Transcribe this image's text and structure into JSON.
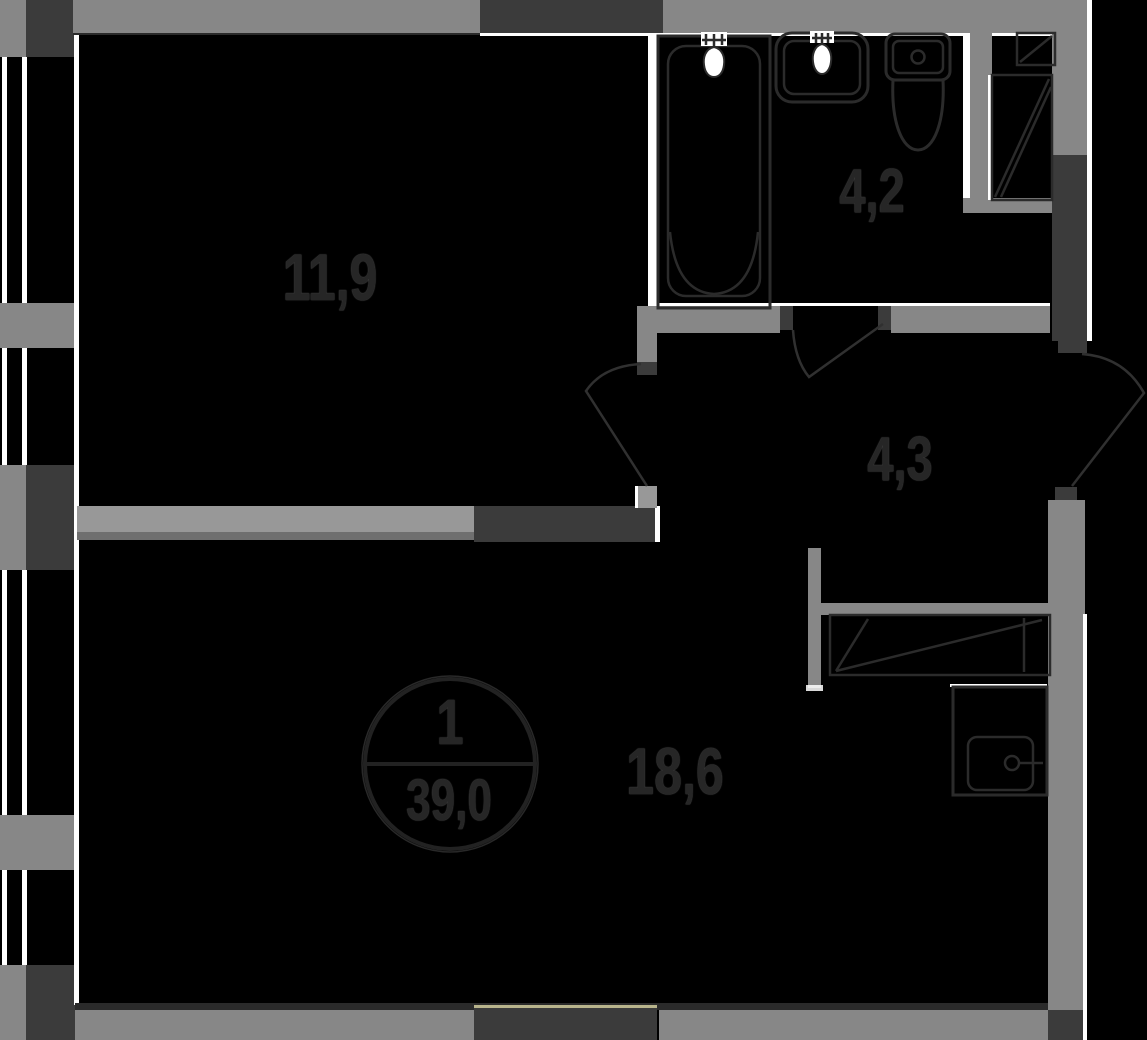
{
  "title": "apartment-floor-plan",
  "labels": {
    "room1_area": "11,9",
    "bathroom_area": "4,2",
    "hallway_area": "4,3",
    "living_area": "18,6"
  },
  "unit_stamp": {
    "number": "1",
    "total_area": "39,0"
  },
  "icons": {
    "bathtub": "bathtub-icon",
    "sink": "sink-icon",
    "toilet": "toilet-icon",
    "vent_duct_small": "vent-duct-icon",
    "vent_duct_tall": "vent-duct-icon",
    "wardrobe": "wardrobe-icon",
    "washing_machine": "washing-machine-icon",
    "door_room": "door-swing-icon",
    "door_bathroom": "door-swing-icon",
    "door_entrance": "door-swing-icon",
    "windows": "window-glazing-icon"
  },
  "colors": {
    "background": "#000000",
    "wall_gray": "#878787",
    "wall_dark": "#3b3b3b",
    "wall_light": "#989898",
    "wall_mid": "#6f6f6f",
    "line_white": "#ffffff",
    "ink": "#262626",
    "fixture": "#2b2b2b",
    "accent_olive": "#b8b48c"
  }
}
